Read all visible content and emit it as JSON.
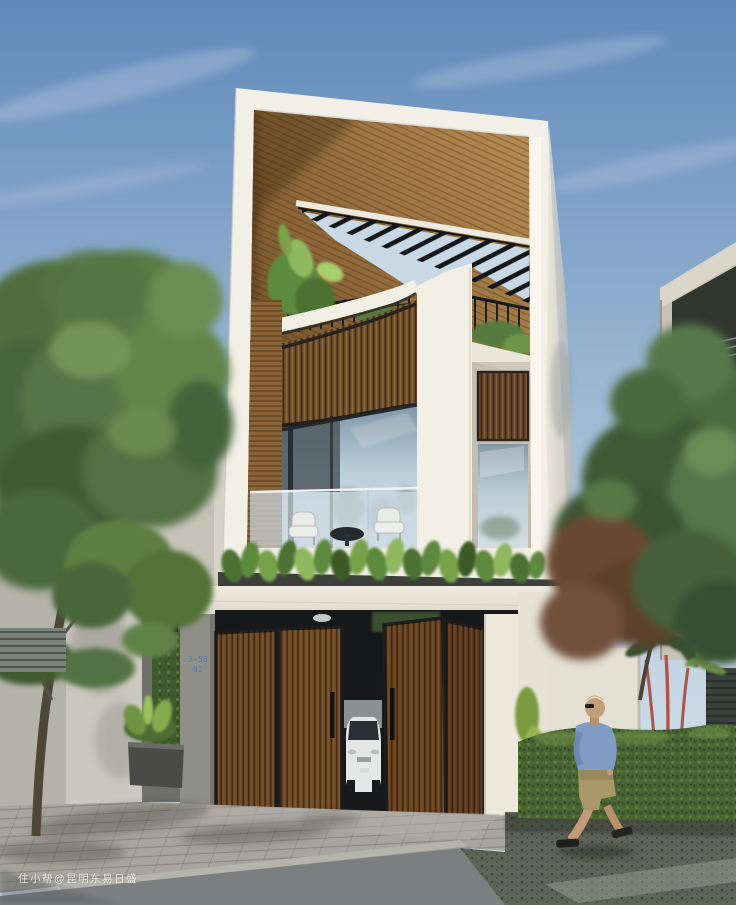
{
  "watermark": {
    "text": "住小帮@昆明东易日盛"
  },
  "house": {
    "number_line1": "3-50",
    "number_line2": "62"
  },
  "palette": {
    "sky-top": "#6189ba",
    "sky-mid": "#9ab8d4",
    "sky-low": "#cfdde8",
    "frame-white": "#f2efe6",
    "wood-mid": "#8a6437",
    "wood-light": "#b68d52",
    "wood-dark": "#5e4223",
    "louver-wood": "#7a5530",
    "door-wood": "#6f4a26",
    "steel-black": "#15181c",
    "leaf-green": "#5d8a3c",
    "hedge-green": "#4a6534",
    "glass-blue": "#b9cdd9",
    "neighbor-wall": "#c7c3b6",
    "pave-light": "#a7a59e",
    "asphalt": "#7c7f80",
    "pave-dark": "#5f6459",
    "ledge-dark": "#3c3f3a",
    "shirt-blue": "#7f9cc4",
    "shorts-khaki": "#a8986a",
    "skin": "#c49a78",
    "car-white": "#e4e7e6"
  }
}
